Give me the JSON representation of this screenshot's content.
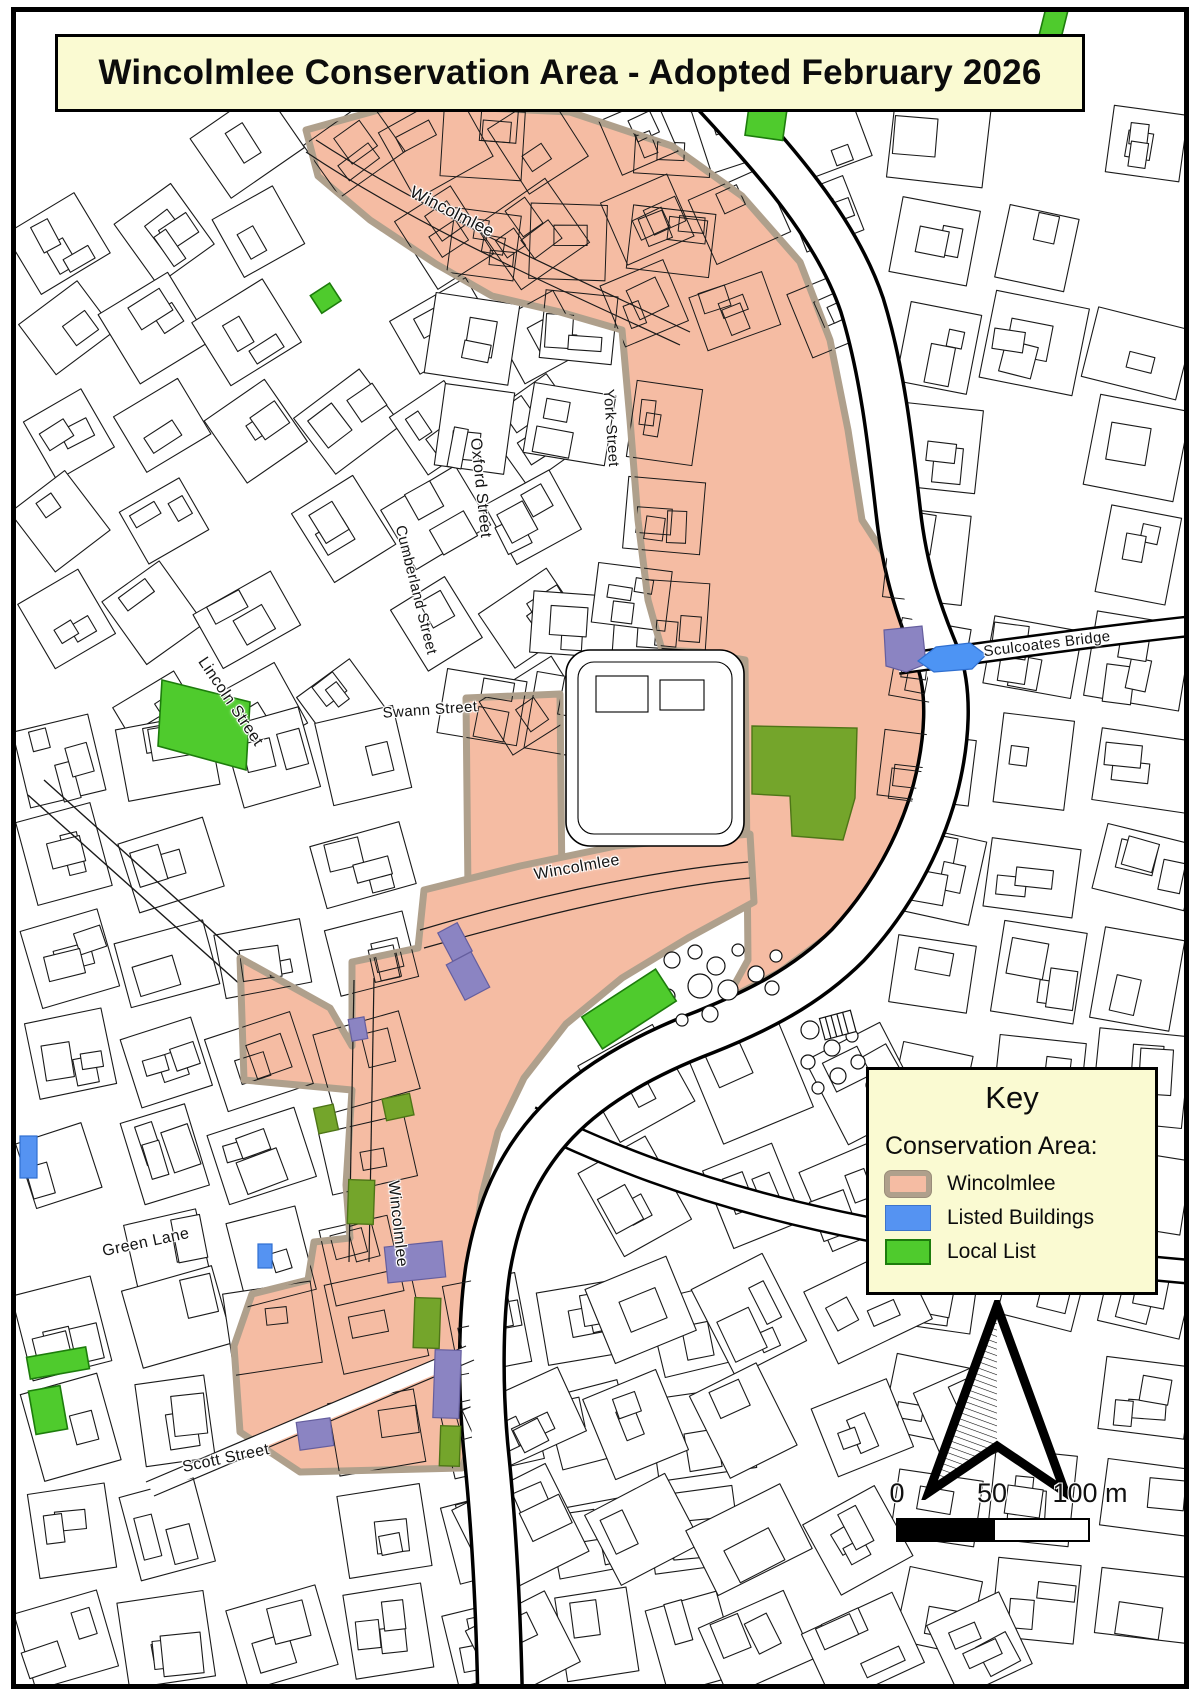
{
  "title_banner": {
    "text": "Wincolmlee Conservation Area - Adopted February 2026"
  },
  "legend": {
    "title": "Key",
    "subtitle": "Conservation Area:",
    "items": [
      {
        "label": "Wincolmlee",
        "swatch_color": "#F5BCA3",
        "swatch_border": "#AFA08C"
      },
      {
        "label": "Listed Buildings",
        "swatch_color": "#5593F2"
      },
      {
        "label": "Local List",
        "swatch_color": "#4FCB2D",
        "swatch_border": "#1D7C0C"
      }
    ]
  },
  "street_labels": [
    {
      "name": "wincolmlee-north",
      "text": "Wincolmlee"
    },
    {
      "name": "oxford-street",
      "text": "Oxford Street"
    },
    {
      "name": "york-street",
      "text": "York Street"
    },
    {
      "name": "cumberland-street",
      "text": "Cumberland Street"
    },
    {
      "name": "lincoln-street",
      "text": "Lincoln Street"
    },
    {
      "name": "swann-street",
      "text": "Swann Street"
    },
    {
      "name": "wincolmlee-mid",
      "text": "Wincolmlee"
    },
    {
      "name": "sculcoates-bridge",
      "text": "Sculcoates Bridge"
    },
    {
      "name": "wincolmlee-south",
      "text": "Wincolmlee"
    },
    {
      "name": "green-lane",
      "text": "Green Lane"
    },
    {
      "name": "scott-street",
      "text": "Scott Street"
    }
  ],
  "scale_bar": {
    "labels": [
      "0",
      "50",
      "100 m"
    ]
  },
  "icons": {
    "north_arrow": "north-arrow"
  },
  "map_colors": {
    "conservation_area_fill": "#F5BCA3",
    "conservation_area_border": "#AFA08C",
    "listed_building_blue": "#5593F2",
    "listed_building_over_area": "#8B84C2",
    "local_list_green": "#4FCB2D",
    "local_list_over_area": "#74A52B",
    "panel_background": "#FAFAD2",
    "linework": "#1a1a1a"
  }
}
